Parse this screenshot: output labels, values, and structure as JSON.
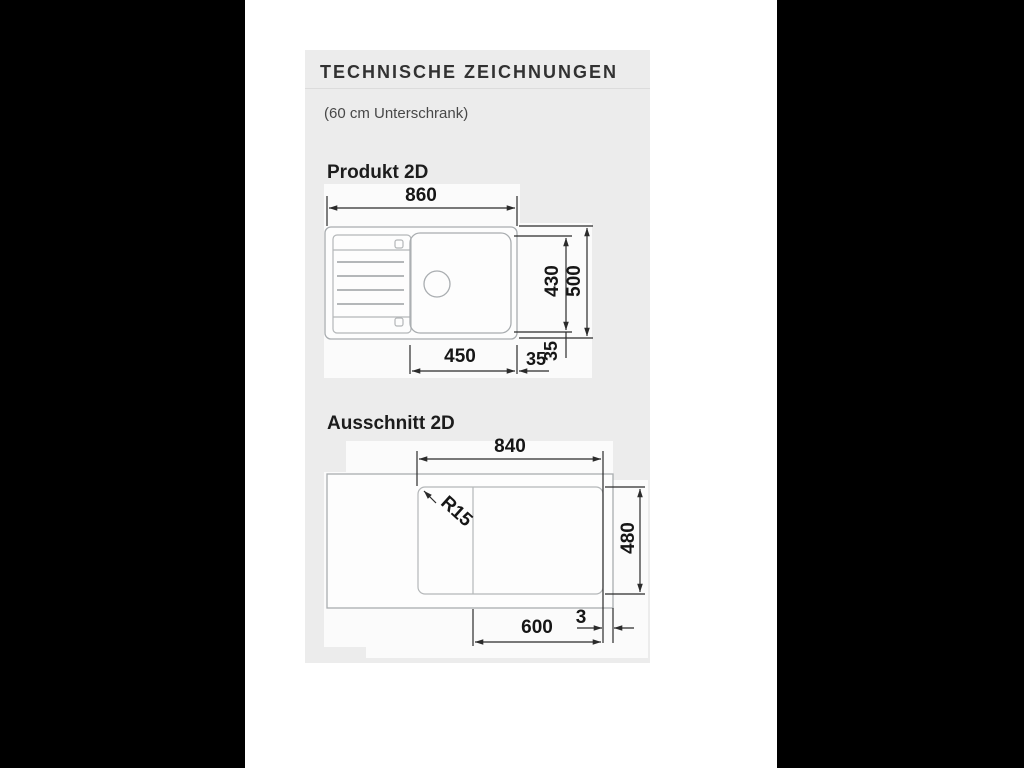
{
  "header": {
    "title": "TECHNISCHE ZEICHNUNGEN",
    "subtitle": "(60 cm Unterschrank)"
  },
  "produkt": {
    "title": "Produkt 2D",
    "dim_total_width": "860",
    "dim_bowl_width": "450",
    "dim_bowl_depth": "430",
    "dim_total_depth": "500",
    "dim_offset_horizontal": "35",
    "dim_offset_vertical": "35"
  },
  "ausschnitt": {
    "title": "Ausschnitt 2D",
    "dim_cutout_width": "840",
    "dim_corner_radius": "R15",
    "dim_cutout_depth": "480",
    "dim_cabinet_width": "600",
    "dim_edge_gap": "3"
  },
  "colors": {
    "letterbox": "#000000",
    "page_background": "#ffffff",
    "panel_background": "#ececec",
    "drawing_background": "#fbfbfb",
    "drawing_lines": "#a9adb0",
    "dimension_lines": "#2b2b2b",
    "text": "#161616"
  }
}
